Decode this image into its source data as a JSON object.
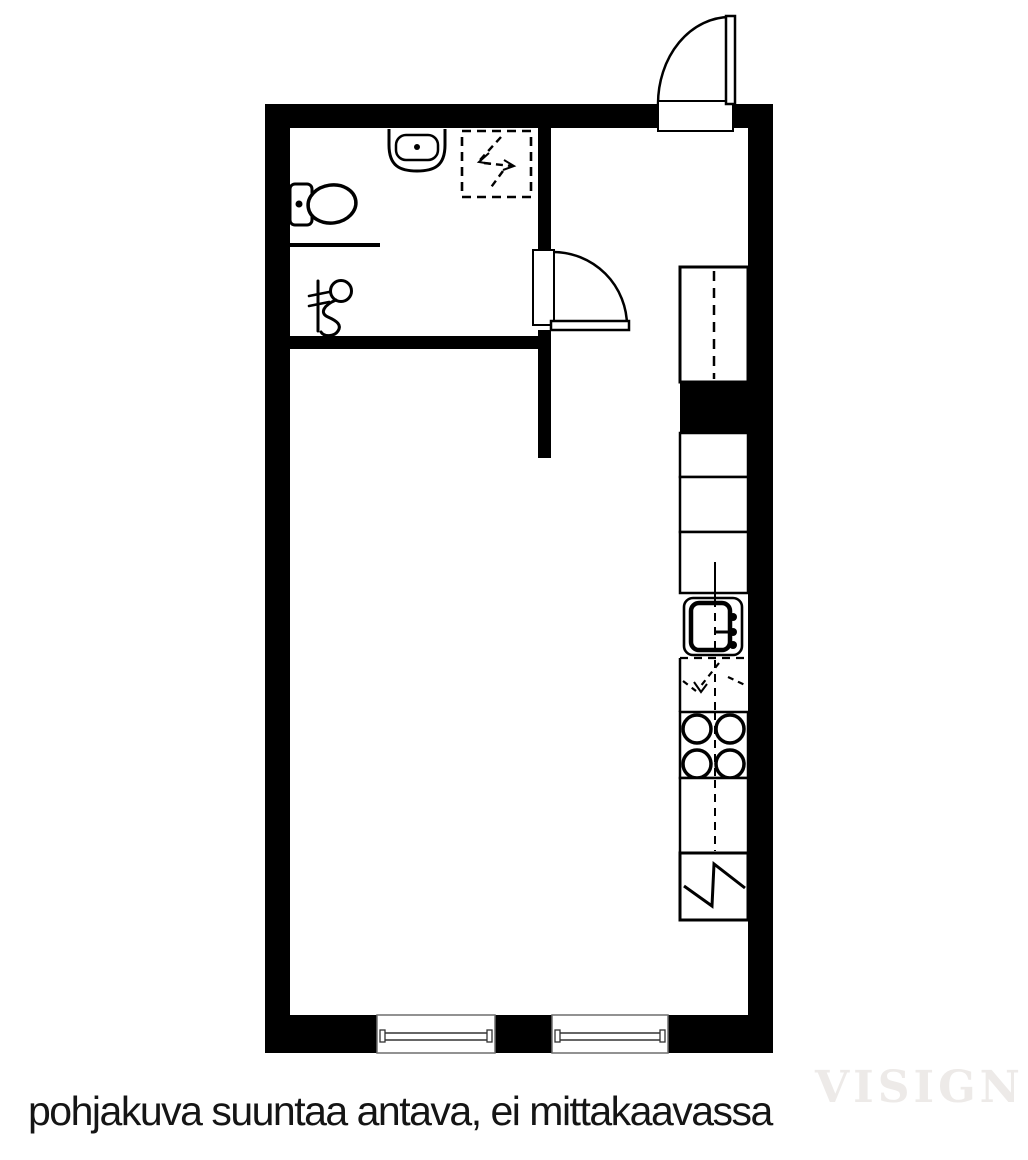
{
  "caption": {
    "text": "pohjakuva suuntaa antava, ei mittakaavassa"
  },
  "watermark": {
    "text": "VISIGN"
  },
  "colors": {
    "wall": "#000000",
    "background": "#ffffff",
    "window_frame": "#6e6e6e",
    "watermark": "#edeae8",
    "caption_text": "#151515"
  },
  "floorplan": {
    "rooms": [
      {
        "name": "bathroom"
      },
      {
        "name": "entry"
      },
      {
        "name": "main-room-with-kitchen"
      }
    ],
    "fixtures": [
      {
        "name": "entrance-door",
        "type": "door-swing-out"
      },
      {
        "name": "bathroom-door",
        "type": "door-swing-right"
      },
      {
        "name": "toilet"
      },
      {
        "name": "washbasin"
      },
      {
        "name": "shower-mixer"
      },
      {
        "name": "appliance-reservation-dashed-box",
        "symbol": "dashed-zigzag"
      },
      {
        "name": "tall-cabinet",
        "symbol": "dashed-centerline"
      },
      {
        "name": "kitchen-cabinet",
        "count": 4
      },
      {
        "name": "kitchen-sink",
        "symbol": "bowl-with-faucet"
      },
      {
        "name": "dishwasher-reservation",
        "symbol": "dashed-zigzag"
      },
      {
        "name": "stove",
        "symbol": "four-burners"
      },
      {
        "name": "refrigerator",
        "symbol": "solid-zigzag"
      },
      {
        "name": "window",
        "count": 2
      }
    ]
  }
}
